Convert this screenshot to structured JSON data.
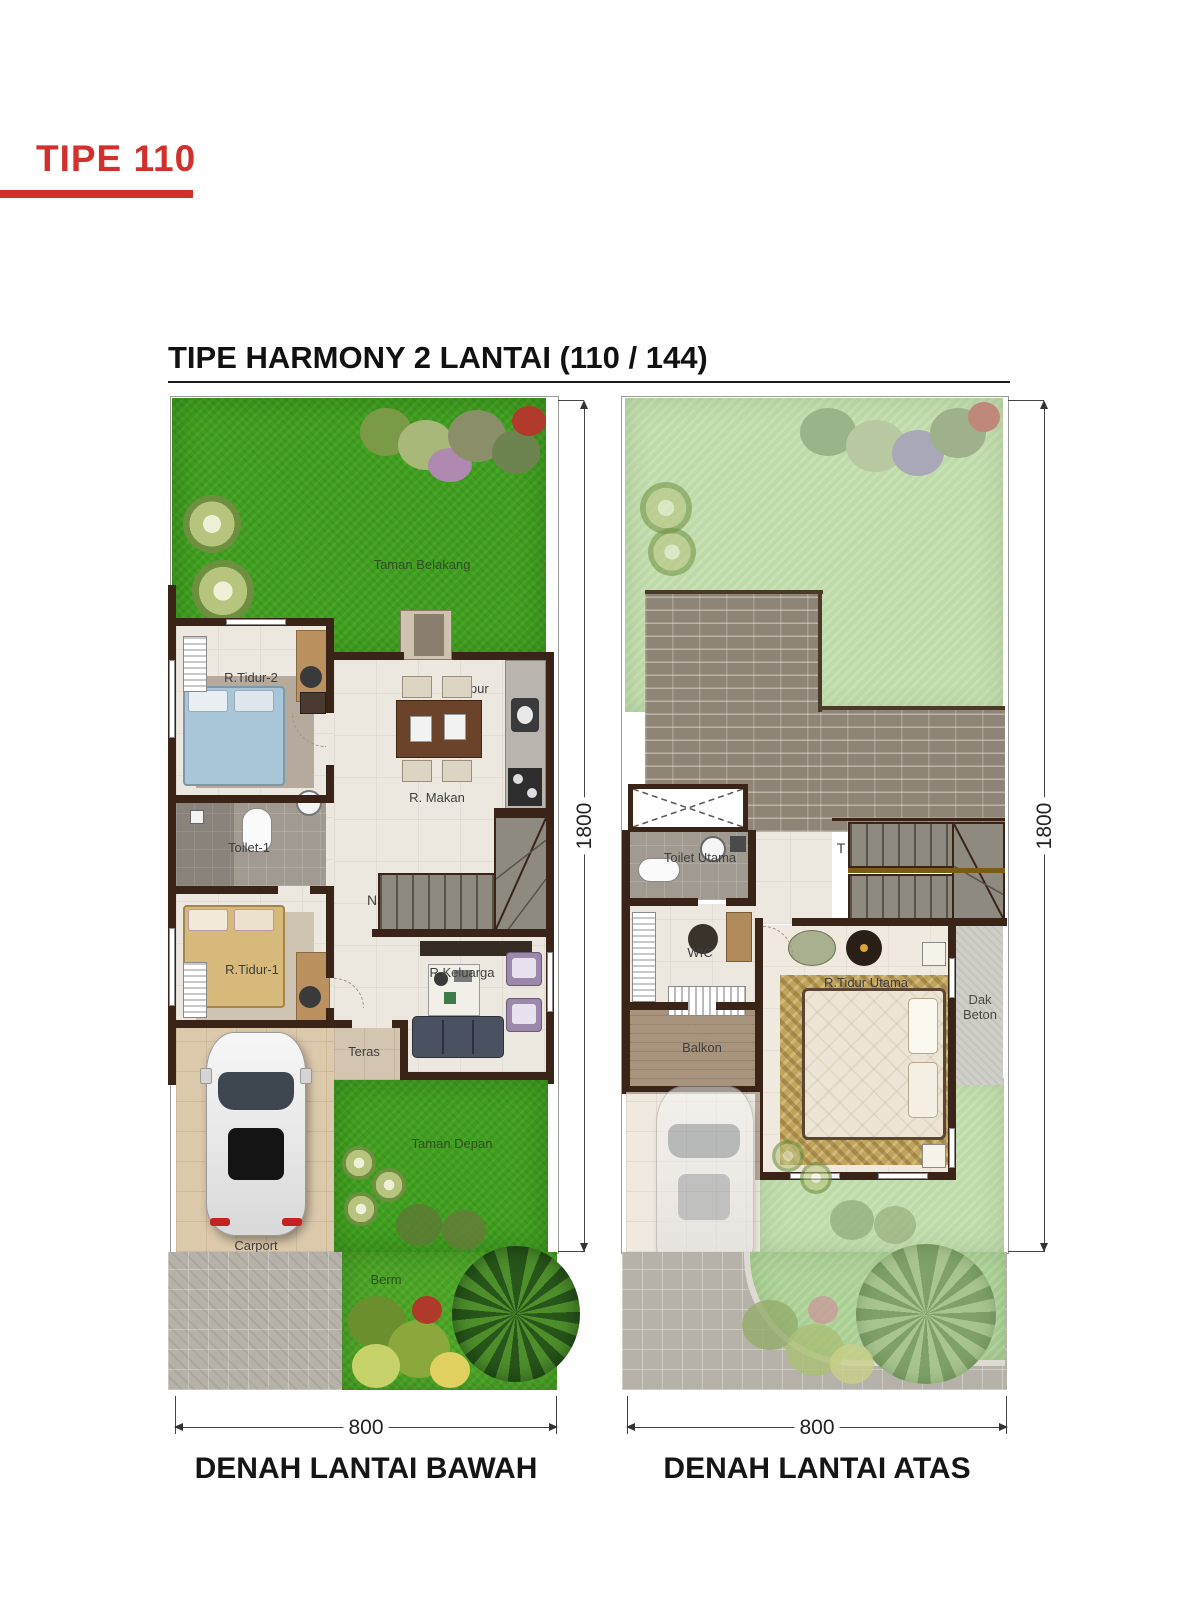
{
  "header": {
    "type_label": "TIPE 110",
    "title": "TIPE HARMONY 2 LANTAI  (110 / 144)"
  },
  "colors": {
    "accent_red": "#d2302c",
    "grass_green": "#3f9e1d",
    "faded_grass_green": "#bedaa8",
    "roof_brick": "#8e8577",
    "wall_brown": "#3a2417",
    "floor_beige": "#ece7df",
    "paving_gray": "#b7b2a9",
    "carport_tan": "#dcc9ac"
  },
  "plans": {
    "bawah": {
      "caption": "DENAH LANTAI BAWAH",
      "width_dim": "800",
      "height_dim": "1800",
      "labels": {
        "taman_belakang": "Taman Belakang",
        "r_tidur_2": "R.Tidur-2",
        "dapur": "Dapur",
        "r_makan": "R. Makan",
        "toilet_1": "Toilet-1",
        "r_tidur_1": "R.Tidur-1",
        "r_keluarga": "R.Keluarga",
        "teras": "Teras",
        "carport": "Carport",
        "taman_depan": "Taman Depan",
        "berm": "Berm",
        "stair_marker": "N"
      }
    },
    "atas": {
      "caption": "DENAH LANTAI ATAS",
      "width_dim": "800",
      "height_dim": "1800",
      "labels": {
        "toilet_utama": "Toilet Utama",
        "wic": "WIC",
        "balkon": "Balkon",
        "r_tidur_utama": "R.Tidur Utama",
        "dak_beton": "Dak Beton",
        "stair_marker": "T"
      }
    }
  }
}
